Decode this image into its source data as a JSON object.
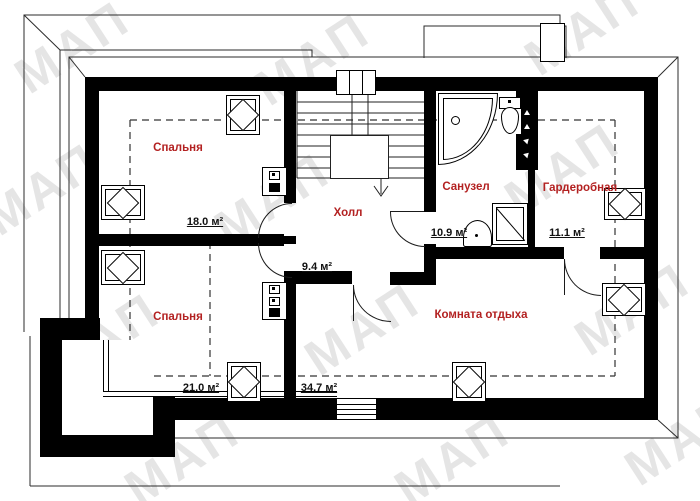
{
  "plan": {
    "watermark_text": "МАП",
    "rooms": [
      {
        "name": "Спальня",
        "area": "18.0 м²"
      },
      {
        "name": "Спальня",
        "area": "21.0 м²"
      },
      {
        "name": "Холл",
        "area": "9.4 м²"
      },
      {
        "name": "Санузел",
        "area": "10.9 м²"
      },
      {
        "name": "Гардеробная",
        "area": "11.1 м²"
      },
      {
        "name": "Комната отдыха",
        "area": "34.7 м²"
      }
    ],
    "colors": {
      "wall": "#000000",
      "room_label": "#b32121",
      "area_label": "#111111",
      "watermark": "#c9c9c9"
    }
  }
}
